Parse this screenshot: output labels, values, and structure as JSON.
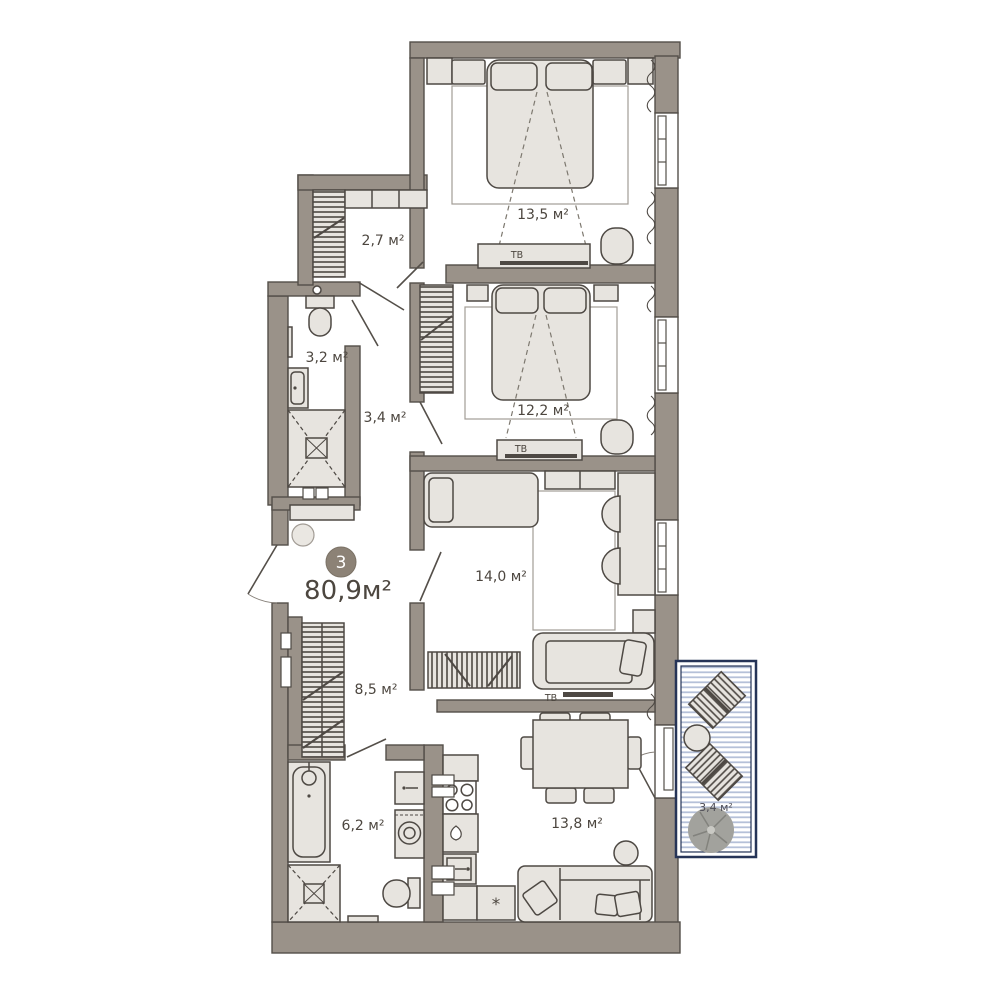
{
  "plan": {
    "badge": {
      "rooms_count": "3"
    },
    "total_area": "80,9м²",
    "rooms": [
      {
        "id": "bedroom-1",
        "area_label": "13,5 м²"
      },
      {
        "id": "wardrobe-room",
        "area_label": "2,7 м²"
      },
      {
        "id": "bathroom-1",
        "area_label": "3,2 м²"
      },
      {
        "id": "hallway-1",
        "area_label": "3,4 м²"
      },
      {
        "id": "bedroom-2",
        "area_label": "12,2 м²"
      },
      {
        "id": "kids-room",
        "area_label": "14,0 м²"
      },
      {
        "id": "hallway-2",
        "area_label": "8,5 м²"
      },
      {
        "id": "bathroom-2",
        "area_label": "6,2 м²"
      },
      {
        "id": "living-kitchen",
        "area_label": "13,8 м²"
      },
      {
        "id": "balcony",
        "area_label": "3,4 м²"
      }
    ],
    "tv_labels": {
      "bedroom1": "ТВ",
      "bedroom2": "ТВ",
      "kids_room": "ТВ"
    },
    "appliance_marks": {
      "kitchen_star": "*"
    },
    "colors": {
      "wall": "#9a9289",
      "furniture": "#e7e4df",
      "balcony_stripe": "#b5c0d8",
      "balcony_frame": "#263457",
      "badge": "#8c8276",
      "text": "#4c463f"
    }
  }
}
